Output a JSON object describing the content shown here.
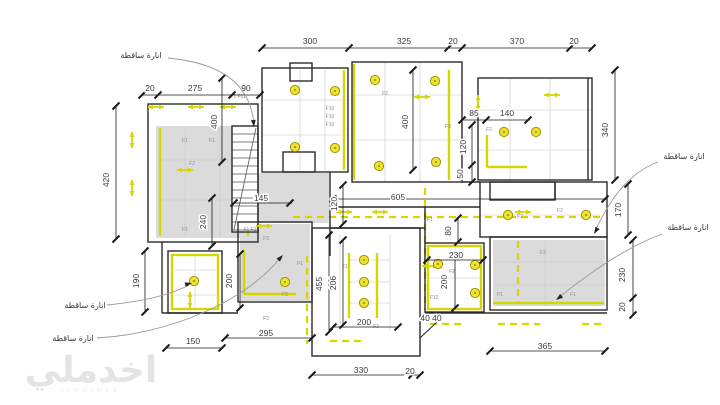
{
  "drawing_type": "lighting-ceiling-plan",
  "watermark": {
    "text": "اخدملي",
    "caption": "IKHDIMLY"
  },
  "colors": {
    "wall": "#2b2b2b",
    "symbol": "#d6d600",
    "fixture_fill": "#f2e135",
    "fixture_stroke": "#9a9a00",
    "ceiling_fill": "#dbdbdb",
    "dim_line": "#1a1a1a",
    "dim_text": "#3a3a3a",
    "leader": "#999999",
    "grid": "#c6c6c6",
    "fixture_label": "#8c8c8c"
  },
  "annotations": [
    {
      "text": "انارة ساقطة",
      "x": 141,
      "y": 58,
      "leader": "M168,58 C232,64 251,92 254,124",
      "ax": 254,
      "ay": 127,
      "adx": 0.1,
      "ady": 1
    },
    {
      "text": "انارة ساقطة",
      "x": 684,
      "y": 159,
      "leader": "M658,162 C625,174 607,206 595,231",
      "ax": 594,
      "ay": 234,
      "adx": -0.5,
      "ady": 0.85
    },
    {
      "text": "انارة ساقطة",
      "x": 688,
      "y": 230,
      "leader": "M662,234 C622,249 586,276 558,298",
      "ax": 556,
      "ay": 300,
      "adx": -0.8,
      "ady": 0.6
    },
    {
      "text": "انارة ساقطة",
      "x": 85,
      "y": 308,
      "leader": "M107,305 C148,301 174,293 189,285",
      "ax": 192,
      "ay": 283,
      "adx": 1,
      "ady": -0.25
    },
    {
      "text": "انارة ساقطة",
      "x": 73,
      "y": 341,
      "leader": "M97,338 C170,334 246,301 280,258",
      "ax": 283,
      "ay": 255,
      "adx": 0.7,
      "ady": -0.75
    }
  ],
  "dims_h": [
    {
      "t": "300",
      "x": 310,
      "y": 44
    },
    {
      "t": "325",
      "x": 404,
      "y": 44
    },
    {
      "t": "20",
      "x": 453,
      "y": 44
    },
    {
      "t": "370",
      "x": 517,
      "y": 44
    },
    {
      "t": "20",
      "x": 574,
      "y": 44
    },
    {
      "t": "20",
      "x": 150,
      "y": 91
    },
    {
      "t": "275",
      "x": 195,
      "y": 91
    },
    {
      "t": "90",
      "x": 246,
      "y": 91
    },
    {
      "t": "85",
      "x": 474,
      "y": 116
    },
    {
      "t": "140",
      "x": 507,
      "y": 116
    },
    {
      "t": "145",
      "x": 261,
      "y": 201
    },
    {
      "t": "605",
      "x": 398,
      "y": 200
    },
    {
      "t": "230",
      "x": 456,
      "y": 258
    },
    {
      "t": "40 40",
      "x": 431,
      "y": 321
    },
    {
      "t": "295",
      "x": 266,
      "y": 336
    },
    {
      "t": "150",
      "x": 193,
      "y": 344
    },
    {
      "t": "200",
      "x": 364,
      "y": 325
    },
    {
      "t": "330",
      "x": 361,
      "y": 373
    },
    {
      "t": "20",
      "x": 410,
      "y": 374
    },
    {
      "t": "365",
      "x": 545,
      "y": 349
    }
  ],
  "dims_v": [
    {
      "t": "420",
      "x": 109,
      "y": 180
    },
    {
      "t": "400",
      "x": 217,
      "y": 122
    },
    {
      "t": "400",
      "x": 408,
      "y": 122
    },
    {
      "t": "240",
      "x": 206,
      "y": 222
    },
    {
      "t": "120",
      "x": 337,
      "y": 204
    },
    {
      "t": "120",
      "x": 466,
      "y": 147
    },
    {
      "t": "50",
      "x": 463,
      "y": 174
    },
    {
      "t": "340",
      "x": 608,
      "y": 130
    },
    {
      "t": "170",
      "x": 621,
      "y": 210
    },
    {
      "t": "80",
      "x": 451,
      "y": 231
    },
    {
      "t": "190",
      "x": 139,
      "y": 281
    },
    {
      "t": "200",
      "x": 232,
      "y": 281
    },
    {
      "t": "455",
      "x": 322,
      "y": 284
    },
    {
      "t": "206",
      "x": 336,
      "y": 283
    },
    {
      "t": "200",
      "x": 447,
      "y": 282
    },
    {
      "t": "230",
      "x": 625,
      "y": 275
    },
    {
      "t": "20",
      "x": 625,
      "y": 307
    }
  ],
  "dim_lines_h": [
    {
      "y": 48,
      "x1": 262,
      "x2": 592,
      "ticks": [
        262,
        349,
        448,
        462,
        570,
        592
      ]
    },
    {
      "y": 95,
      "x1": 142,
      "x2": 260,
      "ticks": [
        142,
        158,
        232,
        260
      ]
    },
    {
      "y": 120,
      "x1": 462,
      "x2": 530,
      "ticks": [
        462,
        486,
        528
      ]
    },
    {
      "y": 203,
      "x1": 234,
      "x2": 292,
      "ticks": [
        234,
        290
      ]
    },
    {
      "y": 199,
      "x1": 333,
      "x2": 605,
      "ticks": [
        333,
        605
      ]
    },
    {
      "y": 338,
      "x1": 225,
      "x2": 312,
      "ticks": [
        225,
        312
      ]
    },
    {
      "y": 348,
      "x1": 166,
      "x2": 222,
      "ticks": [
        166,
        222
      ]
    },
    {
      "y": 327,
      "x1": 333,
      "x2": 398,
      "ticks": [
        333,
        398
      ]
    },
    {
      "y": 375,
      "x1": 312,
      "x2": 420,
      "ticks": [
        312,
        412,
        420
      ]
    },
    {
      "y": 351,
      "x1": 490,
      "x2": 605,
      "ticks": [
        490,
        605
      ]
    },
    {
      "y": 260,
      "x1": 427,
      "x2": 483,
      "ticks": [
        427,
        483
      ]
    }
  ],
  "dim_lines_v": [
    {
      "x": 116,
      "y1": 106,
      "y2": 239,
      "ticks": [
        106,
        239
      ]
    },
    {
      "x": 222,
      "y1": 78,
      "y2": 162,
      "ticks": [
        78,
        162
      ]
    },
    {
      "x": 413,
      "y1": 70,
      "y2": 170,
      "ticks": [
        70,
        170
      ]
    },
    {
      "x": 145,
      "y1": 251,
      "y2": 312,
      "ticks": [
        251,
        312
      ]
    },
    {
      "x": 212,
      "y1": 198,
      "y2": 246,
      "ticks": [
        198,
        246
      ]
    },
    {
      "x": 343,
      "y1": 185,
      "y2": 224,
      "ticks": [
        185,
        224
      ]
    },
    {
      "x": 472,
      "y1": 125,
      "y2": 182,
      "ticks": [
        125,
        165,
        182
      ]
    },
    {
      "x": 615,
      "y1": 70,
      "y2": 180,
      "ticks": [
        70,
        180
      ]
    },
    {
      "x": 628,
      "y1": 184,
      "y2": 235,
      "ticks": [
        184,
        235
      ]
    },
    {
      "x": 458,
      "y1": 218,
      "y2": 242,
      "ticks": [
        218,
        242
      ]
    },
    {
      "x": 240,
      "y1": 254,
      "y2": 308,
      "ticks": [
        254,
        308
      ]
    },
    {
      "x": 329,
      "y1": 235,
      "y2": 332,
      "ticks": [
        235,
        332
      ]
    },
    {
      "x": 343,
      "y1": 240,
      "y2": 325,
      "ticks": [
        240,
        325
      ]
    },
    {
      "x": 455,
      "y1": 255,
      "y2": 308,
      "ticks": [
        255,
        308
      ]
    },
    {
      "x": 633,
      "y1": 240,
      "y2": 315,
      "ticks": [
        240,
        298,
        315
      ]
    }
  ],
  "plan": {
    "gray_areas": [
      [
        156,
        126,
        96,
        112
      ],
      [
        259,
        173,
        70,
        50
      ],
      [
        240,
        224,
        70,
        77
      ],
      [
        493,
        240,
        112,
        66
      ]
    ],
    "wall_rects": [
      [
        148,
        104,
        110,
        138
      ],
      [
        232,
        126,
        26,
        106
      ],
      [
        262,
        68,
        86,
        104
      ],
      [
        352,
        62,
        110,
        120
      ],
      [
        478,
        78,
        114,
        102
      ],
      [
        480,
        182,
        127,
        55
      ],
      [
        490,
        237,
        117,
        73
      ],
      [
        425,
        243,
        59,
        69
      ],
      [
        312,
        228,
        108,
        128
      ],
      [
        238,
        222,
        74,
        80
      ],
      [
        168,
        251,
        54,
        62
      ],
      [
        290,
        63,
        22,
        18
      ],
      [
        283,
        152,
        32,
        20
      ],
      [
        490,
        182,
        65,
        18
      ]
    ],
    "wall_lines": [
      [
        330,
        172,
        330,
        256
      ],
      [
        330,
        207,
        480,
        207
      ],
      [
        330,
        228,
        425,
        228
      ],
      [
        425,
        207,
        425,
        243
      ],
      [
        462,
        182,
        480,
        182
      ],
      [
        588,
        78,
        588,
        180
      ],
      [
        162,
        242,
        162,
        313
      ],
      [
        162,
        313,
        238,
        313
      ],
      [
        425,
        313,
        607,
        313
      ],
      [
        555,
        182,
        555,
        200
      ]
    ],
    "grid_lines": [
      [
        300,
        70,
        300,
        170
      ],
      [
        325,
        70,
        325,
        170
      ],
      [
        262,
        100,
        348,
        100
      ],
      [
        262,
        135,
        348,
        135
      ],
      [
        385,
        62,
        385,
        182
      ],
      [
        420,
        62,
        420,
        182
      ],
      [
        352,
        95,
        462,
        95
      ],
      [
        352,
        140,
        462,
        140
      ],
      [
        510,
        78,
        510,
        180
      ],
      [
        550,
        78,
        550,
        180
      ],
      [
        478,
        110,
        592,
        110
      ],
      [
        478,
        150,
        592,
        150
      ],
      [
        493,
        262,
        605,
        262
      ],
      [
        493,
        285,
        605,
        285
      ],
      [
        545,
        240,
        545,
        306
      ],
      [
        340,
        235,
        340,
        330
      ],
      [
        390,
        235,
        390,
        330
      ],
      [
        350,
        260,
        390,
        260
      ],
      [
        350,
        282,
        390,
        282
      ],
      [
        350,
        303,
        390,
        303
      ],
      [
        195,
        257,
        195,
        308
      ],
      [
        174,
        270,
        216,
        270
      ],
      [
        174,
        295,
        216,
        295
      ],
      [
        185,
        127,
        185,
        237
      ],
      [
        220,
        127,
        220,
        237
      ],
      [
        157,
        160,
        250,
        160
      ],
      [
        157,
        200,
        250,
        200
      ],
      [
        480,
        215,
        600,
        215
      ],
      [
        455,
        246,
        455,
        308
      ],
      [
        428,
        278,
        480,
        278
      ]
    ],
    "yellow_strips": [
      [
        160,
        128,
        160,
        236
      ],
      [
        248,
        128,
        248,
        236
      ],
      [
        344,
        70,
        344,
        170
      ],
      [
        354,
        64,
        354,
        180
      ],
      [
        449,
        70,
        449,
        180
      ],
      [
        487,
        135,
        487,
        167
      ],
      [
        487,
        167,
        527,
        167
      ],
      [
        493,
        303,
        604,
        303
      ],
      [
        349,
        253,
        349,
        318
      ],
      [
        377,
        253,
        377,
        318
      ],
      [
        244,
        250,
        244,
        294
      ],
      [
        244,
        294,
        296,
        294
      ]
    ],
    "yellow_rects": [
      [
        428,
        246,
        53,
        63
      ],
      [
        172,
        255,
        46,
        54
      ]
    ],
    "yellow_dashes": [
      [
        293,
        217,
        603,
        217
      ],
      [
        425,
        188,
        425,
        310
      ],
      [
        518,
        241,
        518,
        302
      ],
      [
        430,
        324,
        462,
        324
      ],
      [
        498,
        324,
        540,
        324
      ],
      [
        582,
        324,
        604,
        324
      ],
      [
        307,
        256,
        307,
        344
      ],
      [
        330,
        341,
        362,
        341
      ]
    ],
    "yellow_arrows": [
      [
        156,
        107,
        "h"
      ],
      [
        196,
        107,
        "h"
      ],
      [
        228,
        107,
        "h"
      ],
      [
        185,
        170,
        "h"
      ],
      [
        422,
        97,
        "h"
      ],
      [
        552,
        95,
        "h"
      ],
      [
        523,
        212,
        "h"
      ],
      [
        380,
        212,
        "h"
      ],
      [
        344,
        212,
        "h"
      ],
      [
        430,
        266,
        "h"
      ],
      [
        264,
        226,
        "h"
      ],
      [
        478,
        103,
        "v"
      ],
      [
        132,
        140,
        "v"
      ],
      [
        132,
        188,
        "v"
      ],
      [
        190,
        300,
        "v"
      ]
    ],
    "lights": [
      [
        295,
        90
      ],
      [
        335,
        91
      ],
      [
        295,
        147
      ],
      [
        335,
        148
      ],
      [
        375,
        80
      ],
      [
        435,
        81
      ],
      [
        436,
        162
      ],
      [
        379,
        166
      ],
      [
        504,
        132
      ],
      [
        536,
        132
      ],
      [
        508,
        215
      ],
      [
        586,
        215
      ],
      [
        364,
        260
      ],
      [
        364,
        282
      ],
      [
        364,
        303
      ],
      [
        194,
        281
      ],
      [
        285,
        282
      ],
      [
        438,
        264
      ],
      [
        475,
        265
      ],
      [
        475,
        293
      ]
    ],
    "fixture_labels": [
      [
        "F1",
        185,
        142
      ],
      [
        "F1",
        212,
        142
      ],
      [
        "F2",
        192,
        165
      ],
      [
        "F1",
        185,
        231
      ],
      [
        "F1 F1",
        250,
        231
      ],
      [
        "F1 F11",
        238,
        98
      ],
      [
        "F10",
        330,
        110
      ],
      [
        "F10",
        330,
        118
      ],
      [
        "F10",
        330,
        126
      ],
      [
        "F2",
        385,
        95
      ],
      [
        "F3",
        448,
        128
      ],
      [
        "F2",
        489,
        131
      ],
      [
        "F1",
        430,
        221
      ],
      [
        "F2",
        520,
        218
      ],
      [
        "F2",
        560,
        212
      ],
      [
        "F2",
        543,
        254
      ],
      [
        "F1",
        573,
        296
      ],
      [
        "F1",
        500,
        296
      ],
      [
        "F2",
        452,
        273
      ],
      [
        "F12",
        434,
        299
      ],
      [
        "F1",
        300,
        265
      ],
      [
        "F1",
        345,
        268
      ],
      [
        "F3",
        376,
        328
      ],
      [
        "F3",
        285,
        296
      ],
      [
        "F3",
        266,
        240
      ],
      [
        "F3",
        266,
        320
      ]
    ],
    "misc_lines": [
      [
        420,
        338,
        438,
        321
      ]
    ],
    "stairs": {
      "x": 232,
      "y": 126,
      "w": 26,
      "h": 106,
      "step": 8
    }
  }
}
